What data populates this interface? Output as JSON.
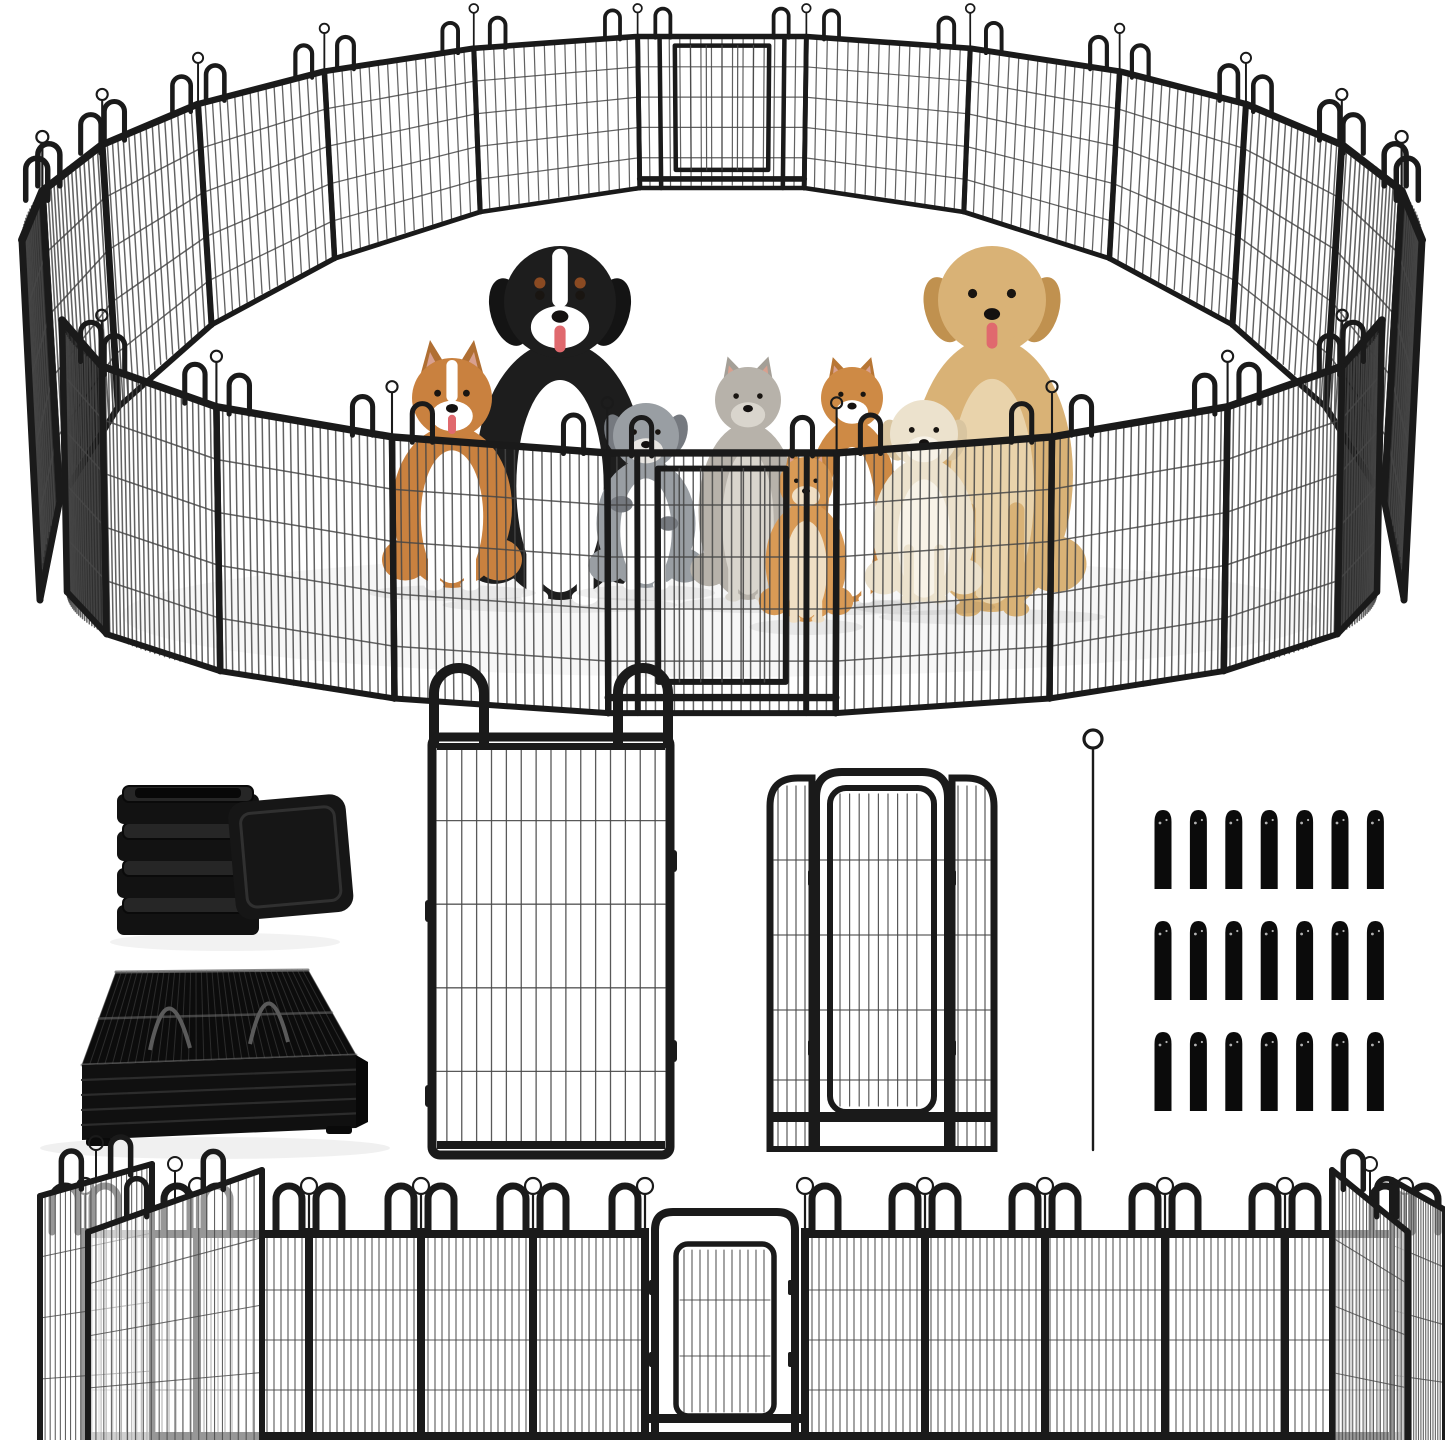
{
  "image": {
    "kind": "product-photo",
    "subject": "heavy-duty metal pet playpen with dogs and cats",
    "background_color": "#ffffff"
  },
  "palette": {
    "frame": "#1a1a1a",
    "frame_dark": "#0e0e0e",
    "wire": "#474747",
    "edge_panel_fill": "#181818",
    "rim_light": "#6f6f6f",
    "shadow": "#000000",
    "eye": "#191511",
    "nose": "#141110",
    "tongue": "#e0696e",
    "inner_ear": "#d8a08f"
  },
  "playpen": {
    "shape": "circular",
    "back_slots": 13,
    "front_slots": 9,
    "back_door_index": 6,
    "front_door_index": 4,
    "wires_per_back_panel": 16,
    "wires_per_front_panel": 24,
    "horizontal_wires_per_panel": 4,
    "doors": 2,
    "loop_handles_per_junction": 2,
    "stake_pin_per_junction": 1
  },
  "animals": [
    {
      "name": "bernese-mountain-dog",
      "type": "dog",
      "colors": {
        "coat": "#1d1d1d",
        "chest": "#ffffff",
        "ear": "#141414",
        "muzzle": "#ffffff",
        "accent": "#8a4a22"
      },
      "features": {
        "tongue": true,
        "blaze": true,
        "brows": true
      }
    },
    {
      "name": "golden-retriever",
      "type": "dog",
      "colors": {
        "coat": "#d9b276",
        "chest": "#e9d3ab",
        "ear": "#c0914f",
        "muzzle": "#d9b276",
        "accent": "#c0914f"
      },
      "features": {
        "tongue": true
      }
    },
    {
      "name": "corgi",
      "type": "dog",
      "colors": {
        "coat": "#c9813f",
        "chest": "#ffffff",
        "ear": "#b06f33",
        "muzzle": "#ffffff",
        "accent": "#b06f33"
      },
      "features": {
        "tongue": true,
        "blaze": true
      }
    },
    {
      "name": "australian-shepherd-puppy",
      "type": "dog",
      "colors": {
        "coat": "#999ea3",
        "chest": "#ffffff",
        "ear": "#75797f",
        "muzzle": "#e8e6e2",
        "accent": "#75797f"
      },
      "features": {
        "merle": true
      }
    },
    {
      "name": "gray-longhair-cat",
      "type": "cat",
      "colors": {
        "coat": "#b7b2aa",
        "chest": "#d9d5cd",
        "ear": "#a49f97",
        "muzzle": "#d9d5cd",
        "accent": "#8f8a82"
      },
      "features": {}
    },
    {
      "name": "orange-white-cat",
      "type": "cat",
      "colors": {
        "coat": "#ce8a45",
        "chest": "#ffffff",
        "ear": "#b87634",
        "muzzle": "#ffffff",
        "accent": "#b87634"
      },
      "features": {}
    },
    {
      "name": "white-puppy",
      "type": "dog",
      "colors": {
        "coat": "#ece2cd",
        "chest": "#f8f3e8",
        "ear": "#d9c5a0",
        "muzzle": "#f8f3e8",
        "accent": "#d9c5a0"
      },
      "features": {}
    },
    {
      "name": "orange-kitten",
      "type": "cat",
      "colors": {
        "coat": "#d99a55",
        "chest": "#f0dfc4",
        "ear": "#c4833e",
        "muzzle": "#f0dfc4",
        "accent": "#c4833e"
      },
      "features": {}
    }
  ],
  "components": {
    "end_caps": {
      "label": "square-post-end-caps",
      "visible_count": 5,
      "color": "#121212",
      "rim": "#262626"
    },
    "folded_stack": {
      "label": "folded-panels-stack",
      "color": "#0c0c0c",
      "slat_color": "#2c2c2c",
      "hatch": "#3a3a3a"
    },
    "single_panel": {
      "label": "single-fence-panel",
      "vertical_wires": 16,
      "horizontal_wires": 4,
      "loop_handles": 2,
      "side_tabs": 4
    },
    "door_panel": {
      "label": "door-fence-panel",
      "has_inner_gate": true,
      "side_sections": 2,
      "hinges": 4
    },
    "ground_stake": {
      "label": "ground-stake-pin",
      "count": 1
    },
    "stake_caps": {
      "label": "stake-caps",
      "rows": 3,
      "columns": 7,
      "count": 21,
      "color": "#0b0b0b",
      "highlight": "#cfcfcf"
    }
  },
  "bottom_row": {
    "left_panels": 5,
    "right_panels": 5,
    "door": 1,
    "angled_end_panels_per_side": 2,
    "horizontal_wires": 3
  }
}
